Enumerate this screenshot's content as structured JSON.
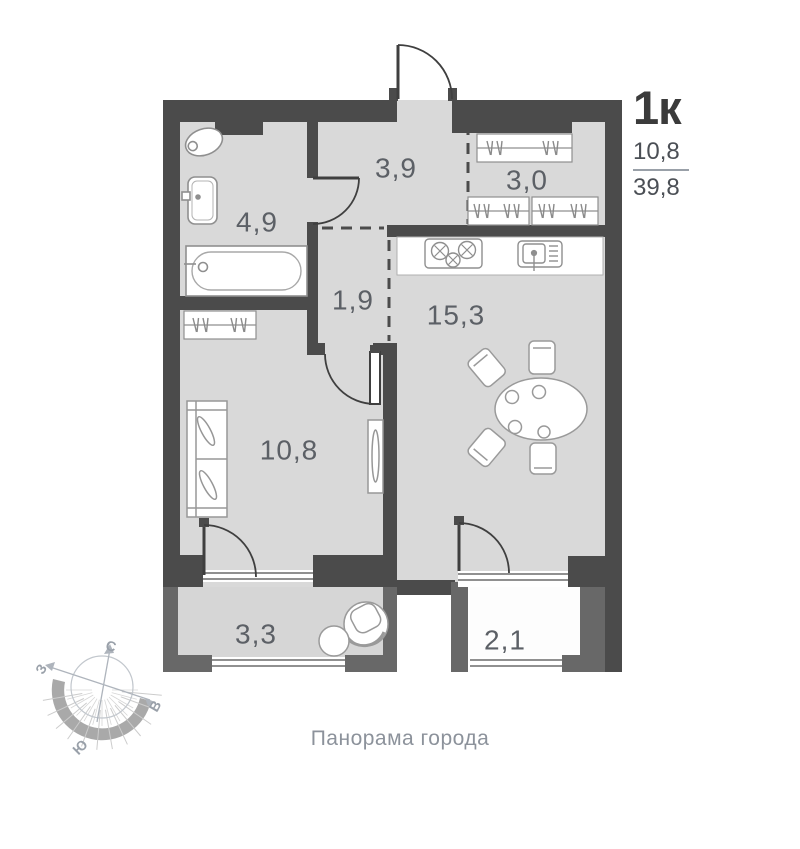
{
  "header": {
    "apartment_type": "1к",
    "living_area": "10,8",
    "total_area": "39,8"
  },
  "rooms": [
    {
      "id": "hallway",
      "area": "3,9"
    },
    {
      "id": "wardrobe",
      "area": "3,0"
    },
    {
      "id": "bathroom",
      "area": "4,9"
    },
    {
      "id": "corridor",
      "area": "1,9"
    },
    {
      "id": "kitchen-living",
      "area": "15,3"
    },
    {
      "id": "bedroom",
      "area": "10,8"
    },
    {
      "id": "loggia-left",
      "area": "3,3"
    },
    {
      "id": "loggia-right",
      "area": "2,1"
    }
  ],
  "compass": {
    "north": "С",
    "west": "З",
    "east": "В",
    "south": "Ю"
  },
  "footer": {
    "caption": "Панорама города"
  },
  "colors": {
    "wall": "#4b4b4b",
    "loggia_wall": "#686868",
    "floor": "#d9d9d9",
    "loggia_right_floor": "#fdfdfd",
    "fixture_outline": "#8f8f8f",
    "room_label": "#5c6066",
    "header_text": "#3b3b3b",
    "caption_text": "#8c929b",
    "compass_gray": "#a3a9b1"
  }
}
